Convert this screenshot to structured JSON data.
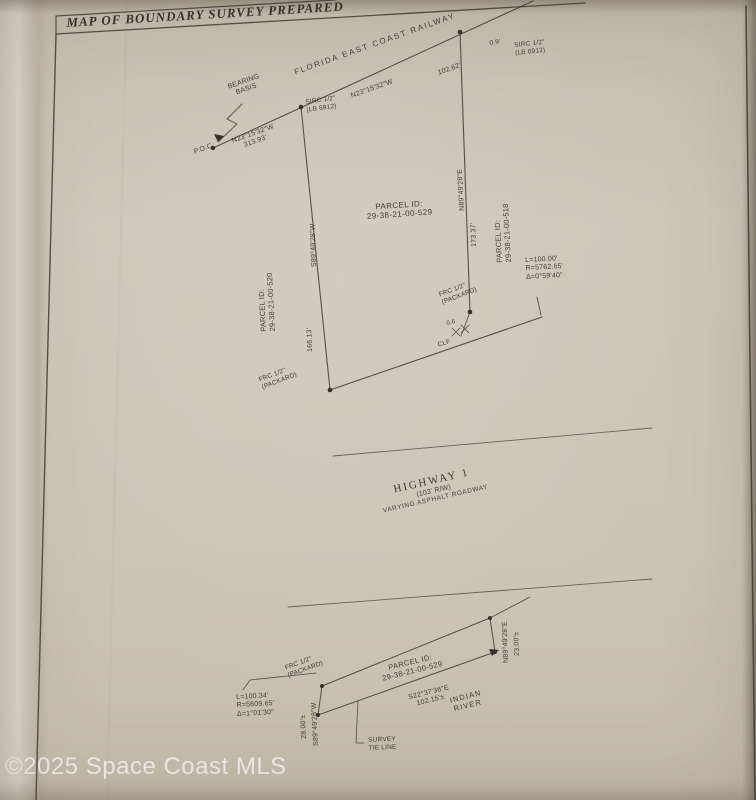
{
  "watermark": "©2025 Space Coast MLS",
  "sheet": {
    "title": "MAP OF BOUNDARY SURVEY PREPARED"
  },
  "railway": {
    "name": "FLORIDA EAST COAST RAILWAY",
    "bearing": "N23°15'32\"W",
    "distance": "102.62'",
    "bearing_basis_1": "BEARING",
    "bearing_basis_2": "BASIS",
    "poc": "P.O.C.",
    "poc_bearing": "N23°15'32\"W",
    "poc_distance": "313.93'"
  },
  "monuments": {
    "ne_offset": "0.9'",
    "sirc_ne_1": "SIRC 1/2\"",
    "sirc_ne_2": "(LB 6912)",
    "sirc_mid_1": "SIRC 1/2\"",
    "sirc_mid_2": "(LB 6912)",
    "frc_se_1": "FRC 1/2\"",
    "frc_se_2": "(PACKARD)",
    "frc_sw_1": "FRC 1/2\"",
    "frc_sw_2": "(PACKARD)",
    "frc_inset_1": "FRC 1/2\"",
    "frc_inset_2": "(PACKARD)",
    "se_offset": "0.6",
    "fence": "CLF"
  },
  "parcel": {
    "id_label": "PARCEL ID:",
    "id": "29-38-21-00-529",
    "west_bearing": "S89°49'28\"W",
    "west_distance": "166.13'",
    "west_parcel_label": "PARCEL ID:",
    "west_parcel_id": "29-38-21-00-520",
    "east_bearing": "N89°49'28\"E",
    "east_distance": "173.37'",
    "east_parcel_label": "PARCEL ID:",
    "east_parcel_id": "29-38-21-00-518"
  },
  "curve_ne": {
    "l": "L=100.00'",
    "r": "R=5762.65'",
    "d": "Δ=0°59'40\""
  },
  "highway": {
    "name": "HIGHWAY 1",
    "rw": "(103' R/W)",
    "desc": "VARYING ASPHALT ROADWAY"
  },
  "inset": {
    "id_label": "PARCEL ID:",
    "id": "29-38-21-00-529",
    "tie_bearing": "S22°37'36\"E",
    "tie_distance": "102.15'±",
    "river_1": "INDIAN",
    "river_2": "RIVER",
    "west_bearing": "S89°49'28\"W",
    "west_distance": "28.00'±",
    "east_bearing": "N89°49'28\"E",
    "east_distance": "23.00'±",
    "curve": {
      "l": "L=100.34'",
      "r": "R=5609.65'",
      "d": "Δ=1°01'30\""
    },
    "tie_label_1": "SURVEY",
    "tie_label_2": "TIE LINE"
  }
}
